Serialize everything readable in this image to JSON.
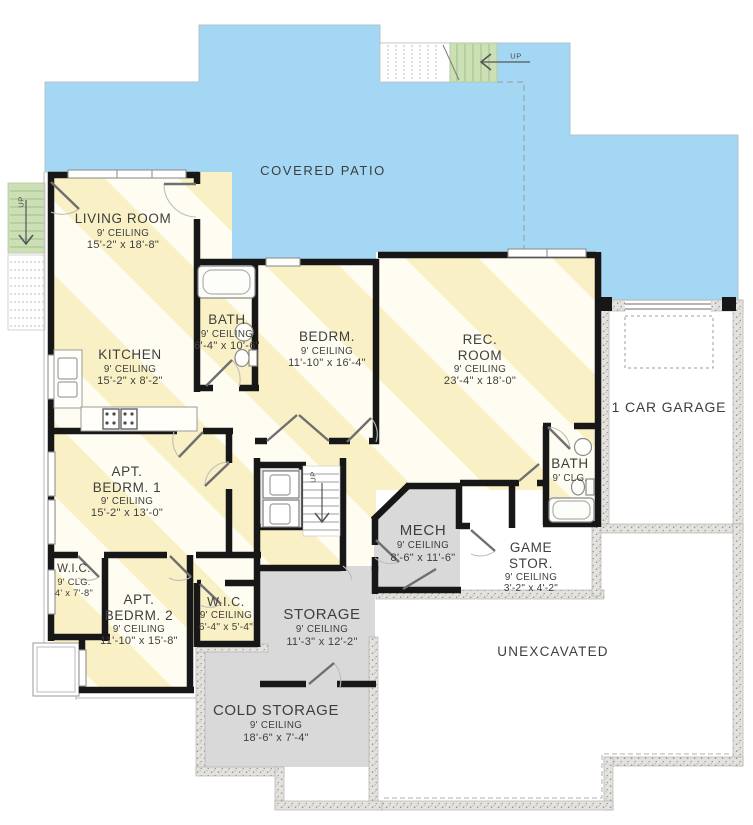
{
  "patio": {
    "label": "COVERED PATIO"
  },
  "stairs": {
    "up_top": "UP",
    "up_left": "UP",
    "up_center": "UP"
  },
  "rooms": [
    {
      "id": "living-room",
      "name": "LIVING ROOM",
      "ceiling": "9' CEILING",
      "size": "15'-2\" x 18'-8\""
    },
    {
      "id": "kitchen",
      "name": "KITCHEN",
      "ceiling": "9' CEILING",
      "size": "15'-2\" x 8'-2\""
    },
    {
      "id": "bath-upper",
      "name": "BATH",
      "ceiling": "9' CEILING",
      "size": "6'-4\" x 10'-6\""
    },
    {
      "id": "bedroom",
      "name": "BEDRM.",
      "ceiling": "9' CEILING",
      "size": "11'-10\" x 16'-4\""
    },
    {
      "id": "rec-room",
      "name_line1": "REC.",
      "name_line2": "ROOM",
      "ceiling": "9' CEILING",
      "size": "23'-4\" x 18'-0\""
    },
    {
      "id": "garage",
      "name": "1 CAR GARAGE"
    },
    {
      "id": "bath-lower",
      "name": "BATH",
      "ceiling": "9' CLG."
    },
    {
      "id": "apt-bedroom-1",
      "name_line1": "APT.",
      "name_line2": "BEDRM. 1",
      "ceiling": "9' CEILING",
      "size": "15'-2\" x 13'-0\""
    },
    {
      "id": "wic-left",
      "name": "W.I.C.",
      "ceiling": "9' CLG.",
      "size": "4' x 7'-8\""
    },
    {
      "id": "apt-bedroom-2",
      "name_line1": "APT.",
      "name_line2": "BEDRM. 2",
      "ceiling": "9' CEILING",
      "size": "11'-10\" x 15'-8\""
    },
    {
      "id": "wic-right",
      "name": "W.I.C.",
      "ceiling": "9' CEILING",
      "size": "6'-4\" x 5'-4\""
    },
    {
      "id": "mech",
      "name": "MECH",
      "ceiling": "9' CEILING",
      "size": "8'-6\" x 11'-6\""
    },
    {
      "id": "game-storage",
      "name_line1": "GAME",
      "name_line2": "STOR.",
      "ceiling": "9' CEILING",
      "size": "3'-2\" x 4'-2\""
    },
    {
      "id": "storage",
      "name": "STORAGE",
      "ceiling": "9' CEILING",
      "size": "11'-3\" x 12'-2\""
    },
    {
      "id": "cold-storage",
      "name": "COLD STORAGE",
      "ceiling": "9' CEILING",
      "size": "18'-6\" x 7'-4\""
    },
    {
      "id": "unexcavated",
      "name": "UNEXCAVATED"
    }
  ],
  "colors": {
    "patio_blue": "#a3d7f3",
    "stripe_yellow": "#f9f1c5",
    "stripe_cream": "#fffdf1",
    "stair_green": "#cce0b5",
    "storage_gray": "#d9d9d9",
    "wall_black": "#171717"
  }
}
